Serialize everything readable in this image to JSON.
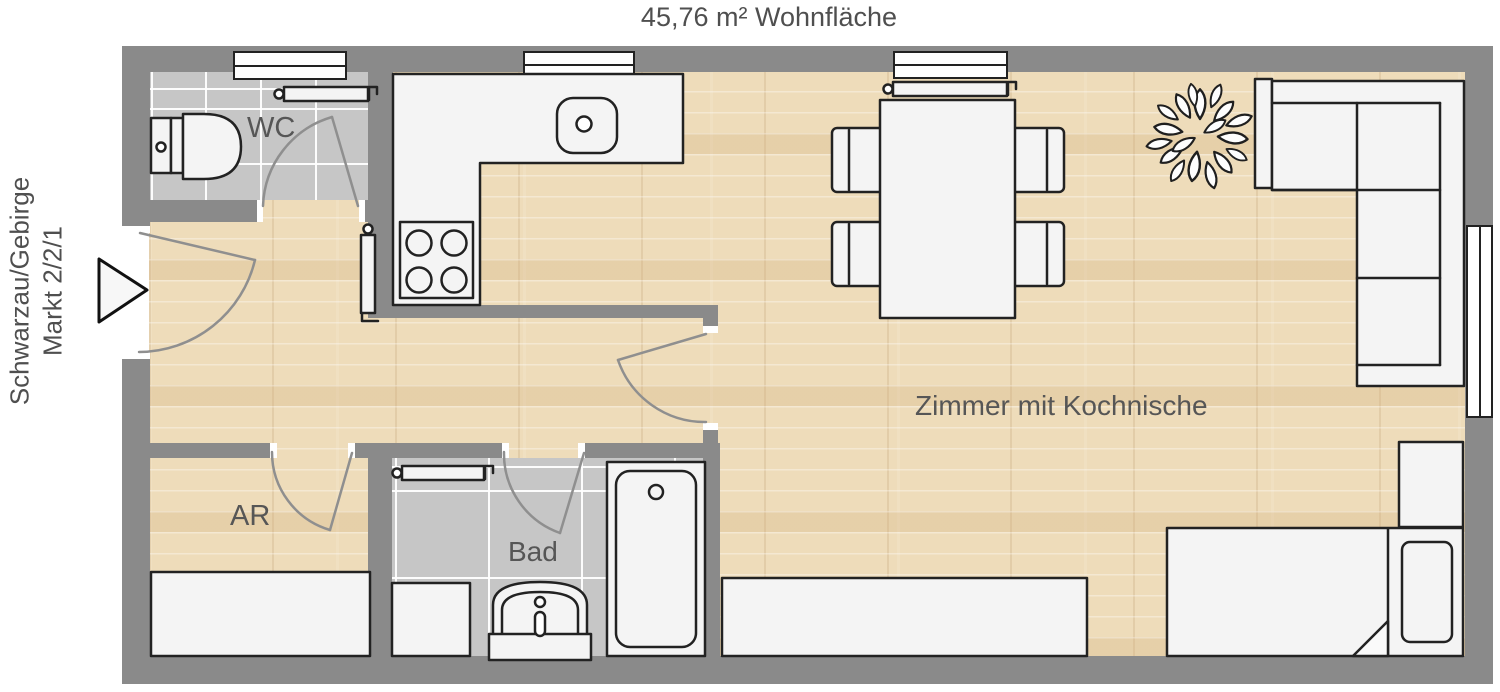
{
  "title": "45,76 m² Wohnfläche",
  "address": {
    "line1": "Schwarzau/Gebirge",
    "line2": "Markt 2/2/1"
  },
  "rooms": {
    "wc": {
      "label": "WC"
    },
    "storage": {
      "label": "AR"
    },
    "bath": {
      "label": "Bad"
    },
    "living": {
      "label": "Zimmer mit Kochnische"
    }
  },
  "symbols": [
    "entrance-arrow-icon",
    "door-arc",
    "window",
    "radiator",
    "toilet",
    "washbasin",
    "bathtub",
    "washing-machine",
    "kitchen-counter",
    "kitchen-sink",
    "stove",
    "dining-table",
    "chair",
    "plant-icon",
    "corner-sofa",
    "bed",
    "pillow",
    "nightstand",
    "sideboard",
    "storage-cabinet"
  ],
  "colors": {
    "wall": "#8a8a8a",
    "wood_floor": "#eedcba",
    "tile_floor": "#c6c6c6",
    "furniture_fill": "#f4f4f4",
    "outline": "#222222",
    "door_arc": "#8f8f8f",
    "label_text": "#565656"
  }
}
